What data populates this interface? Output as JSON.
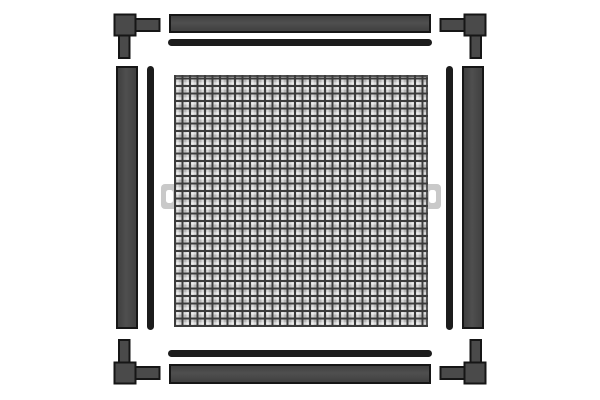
{
  "meta": {
    "description": "exploded-parts-diagram-insect-screen-window-kit",
    "visible_text": "",
    "background": "#ffffff"
  },
  "colors": {
    "part_fill": "#4a4a4a",
    "part_fill_dark": "#3f3f3f",
    "part_outline": "#161616",
    "spline": "#1c1c1c",
    "mesh_base": "#b4b4b4",
    "mesh_grid": "#3c3c3c",
    "tab": "#c9c9c9",
    "tab_hole": "#ffffff",
    "bg": "#ffffff"
  },
  "parts": [
    {
      "id": "frame-bar-top",
      "kind": "frame-profile"
    },
    {
      "id": "frame-bar-bottom",
      "kind": "frame-profile"
    },
    {
      "id": "frame-bar-left",
      "kind": "frame-profile"
    },
    {
      "id": "frame-bar-right",
      "kind": "frame-profile"
    },
    {
      "id": "spline-top",
      "kind": "rubber-spline"
    },
    {
      "id": "spline-bottom",
      "kind": "rubber-spline"
    },
    {
      "id": "spline-left",
      "kind": "rubber-spline"
    },
    {
      "id": "spline-right",
      "kind": "rubber-spline"
    },
    {
      "id": "corner-connector-top-left",
      "kind": "corner-connector"
    },
    {
      "id": "corner-connector-top-right",
      "kind": "corner-connector"
    },
    {
      "id": "corner-connector-bottom-left",
      "kind": "corner-connector"
    },
    {
      "id": "corner-connector-bottom-right",
      "kind": "corner-connector"
    },
    {
      "id": "mesh-panel",
      "kind": "screen-mesh"
    },
    {
      "id": "pull-tab-left",
      "kind": "pull-tab"
    },
    {
      "id": "pull-tab-right",
      "kind": "pull-tab"
    }
  ]
}
